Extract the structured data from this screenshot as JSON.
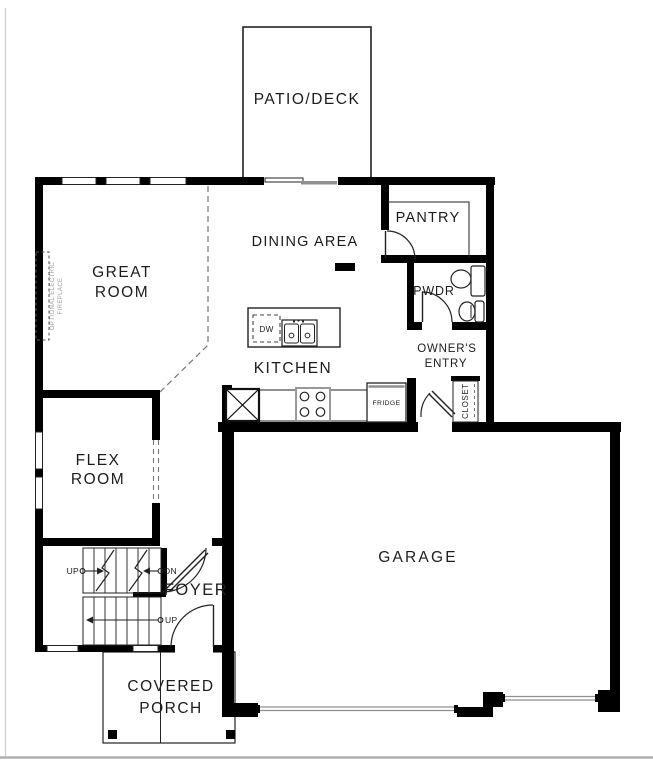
{
  "colors": {
    "bg": "#ffffff",
    "wall": "#000000",
    "line": "#222222",
    "dash": "#777777",
    "gray_door": "#8f8f8f",
    "annotation": "#9b9b9b",
    "text": "#1c1c1c",
    "page_edge": "#b0b0b0"
  },
  "rooms": {
    "patio_deck": "PATIO/DECK",
    "great_room": [
      "GREAT",
      "ROOM"
    ],
    "dining_area": "DINING AREA",
    "pantry": "PANTRY",
    "pwdr": "PWDR",
    "kitchen": "KITCHEN",
    "owners_entry": [
      "OWNER'S",
      "ENTRY"
    ],
    "flex_room": [
      "FLEX",
      "ROOM"
    ],
    "foyer": "FOYER",
    "garage": "GARAGE",
    "covered_porch": [
      "COVERED",
      "PORCH"
    ],
    "closet": "CLOSET"
  },
  "fixtures": {
    "dishwasher": "DW",
    "fridge": "FRIDGE"
  },
  "stairs": {
    "up_upper": "UP",
    "down": "DN",
    "up_lower": "UP"
  },
  "notes": {
    "fireplace": [
      "OPTIONAL ELECTRIC",
      "FIREPLACE"
    ]
  }
}
